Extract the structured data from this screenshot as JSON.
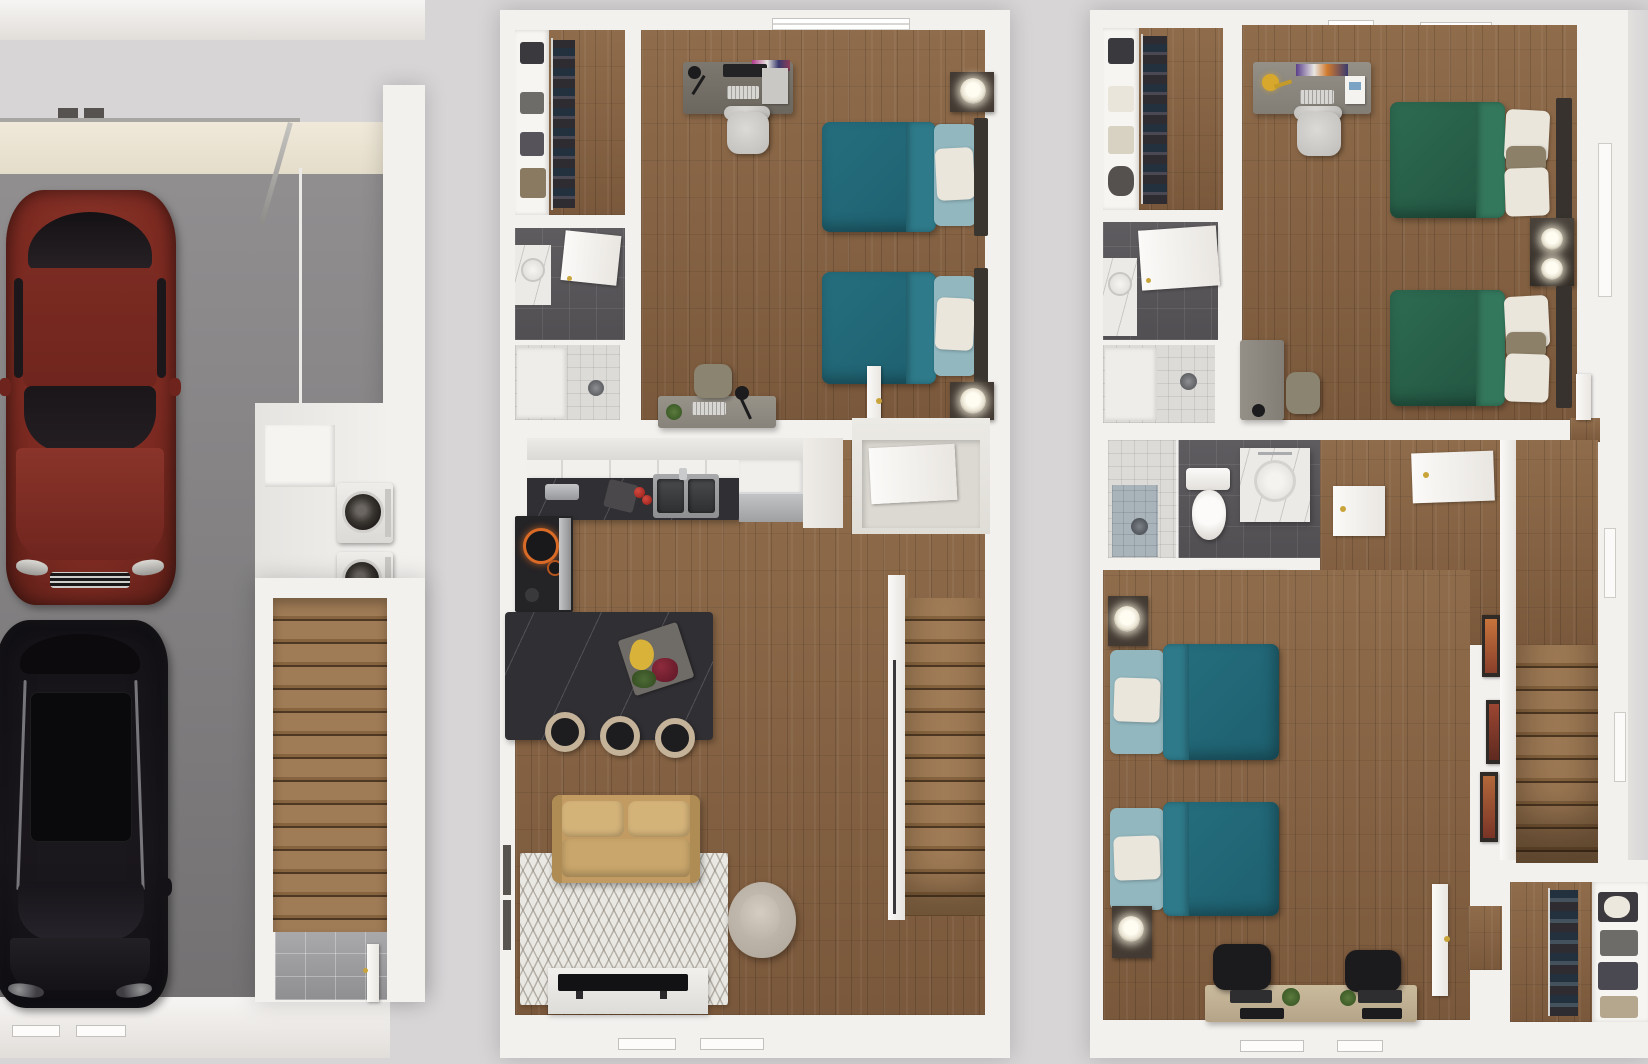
{
  "scene": {
    "type": "3d-floorplan-render",
    "view": "top-down dollhouse",
    "floors": [
      {
        "id": "garage-level",
        "rooms": [
          {
            "name": "garage",
            "items": [
              "open-garage-door",
              "red-sedan",
              "black-suv"
            ]
          },
          {
            "name": "laundry-nook",
            "items": [
              "storage-cabinet",
              "washer",
              "dryer"
            ]
          },
          {
            "name": "stairwell",
            "items": [
              "wood-staircase",
              "tile-landing",
              "entry-door"
            ]
          }
        ]
      },
      {
        "id": "main-level",
        "rooms": [
          {
            "name": "walk-in-closet",
            "items": [
              "shelving-with-clothes",
              "hanging-clothes"
            ]
          },
          {
            "name": "bathroom",
            "items": [
              "vanity-sink",
              "open-door",
              "shower"
            ]
          },
          {
            "name": "bedroom-teal",
            "items": [
              "desk-with-monitor",
              "office-chair",
              "twin-bed-teal",
              "twin-bed-teal",
              "nightstand-lamp",
              "nightstand-lamp",
              "second-desk",
              "desk-chair",
              "window"
            ]
          },
          {
            "name": "kitchen",
            "items": [
              "upper-cabinets",
              "black-counter",
              "toaster",
              "cutting-board",
              "tomatoes",
              "double-sink",
              "dishwasher",
              "range-with-burners",
              "island-with-fruit-tray",
              "bar-stool",
              "bar-stool",
              "bar-stool"
            ]
          },
          {
            "name": "living-room",
            "items": [
              "tan-loveseat",
              "chevron-rug",
              "swivel-armchair",
              "tv-console",
              "television",
              "windows"
            ]
          },
          {
            "name": "stairwell",
            "items": [
              "wood-staircase",
              "handrail",
              "entry-closet"
            ]
          }
        ]
      },
      {
        "id": "upper-level",
        "rooms": [
          {
            "name": "walk-in-closet",
            "items": [
              "shelving-with-clothes",
              "hanging-clothes"
            ]
          },
          {
            "name": "bathroom-ensuite",
            "items": [
              "vanity-sink",
              "open-door",
              "shower"
            ]
          },
          {
            "name": "bedroom-green",
            "items": [
              "desk-with-yellow-lamp",
              "office-chair",
              "twin-bed-green",
              "twin-bed-green",
              "shared-nightstand-lamps",
              "second-desk",
              "desk-chair",
              "door",
              "ceiling-vents",
              "window"
            ]
          },
          {
            "name": "bathroom-hall",
            "items": [
              "shower",
              "toilet",
              "vanity-sink"
            ]
          },
          {
            "name": "hallway",
            "items": [
              "linen-closet-door",
              "linen-closet-door",
              "white-dresser"
            ]
          },
          {
            "name": "bedroom-teal",
            "items": [
              "twin-bed-teal",
              "twin-bed-teal",
              "nightstand-lamp",
              "nightstand-lamp",
              "shared-study-desk",
              "black-office-chair",
              "black-office-chair",
              "monitors",
              "plants",
              "door"
            ]
          },
          {
            "name": "walk-in-closet-2",
            "items": [
              "hanging-clothes",
              "shelving-with-clothes"
            ]
          },
          {
            "name": "stairwell",
            "items": [
              "wood-staircase",
              "wall-art-frames",
              "windows"
            ]
          }
        ]
      }
    ]
  },
  "palette": {
    "bg": "#d7d5d6",
    "wall": "#f3f1ee",
    "wall-shadow": "#ddd9d6",
    "ceiling": "#ece5d5",
    "garage-floor-a": "#918f90",
    "garage-floor-b": "#737172",
    "wood-a": "#8f6c4b",
    "wood-b": "#7a583b",
    "stair-a": "#9f7b56",
    "stair-b": "#86643f",
    "stair-line": "#4e3823",
    "teal": "#256e7e",
    "teal-light": "#2e7a8a",
    "green": "#2d6b51",
    "green-light": "#33775c",
    "pillow-blue": "#92b7bf",
    "pillow-white": "#eae6dc",
    "tan": "#c19b61",
    "tan-light": "#d4b379",
    "rug": "#eae8e2",
    "counter": "#302f33",
    "stool-ring": "#c4b299",
    "steel": "#b5b6b8",
    "tile-dark": "#59575a",
    "tile-light": "#dddbd7",
    "tile-blue": "#a9b3ba",
    "marble": "#eceae6",
    "red-car": "#7c2a21",
    "red-car-light": "#8a342a",
    "black-car": "#17151a",
    "door": "#f5f3f1",
    "knob": "#c9a43b",
    "lamp-yellow": "#d8a82c",
    "desk-dark": "#76716b",
    "desk-gray": "#8b8780",
    "desk-wood": "#c1b091",
    "chair-light": "#d3d1cd",
    "chair-black": "#1b1a1d",
    "chair-olive": "#8a8471",
    "dark-wood": "#433b33",
    "frame": "#2f2a26"
  }
}
